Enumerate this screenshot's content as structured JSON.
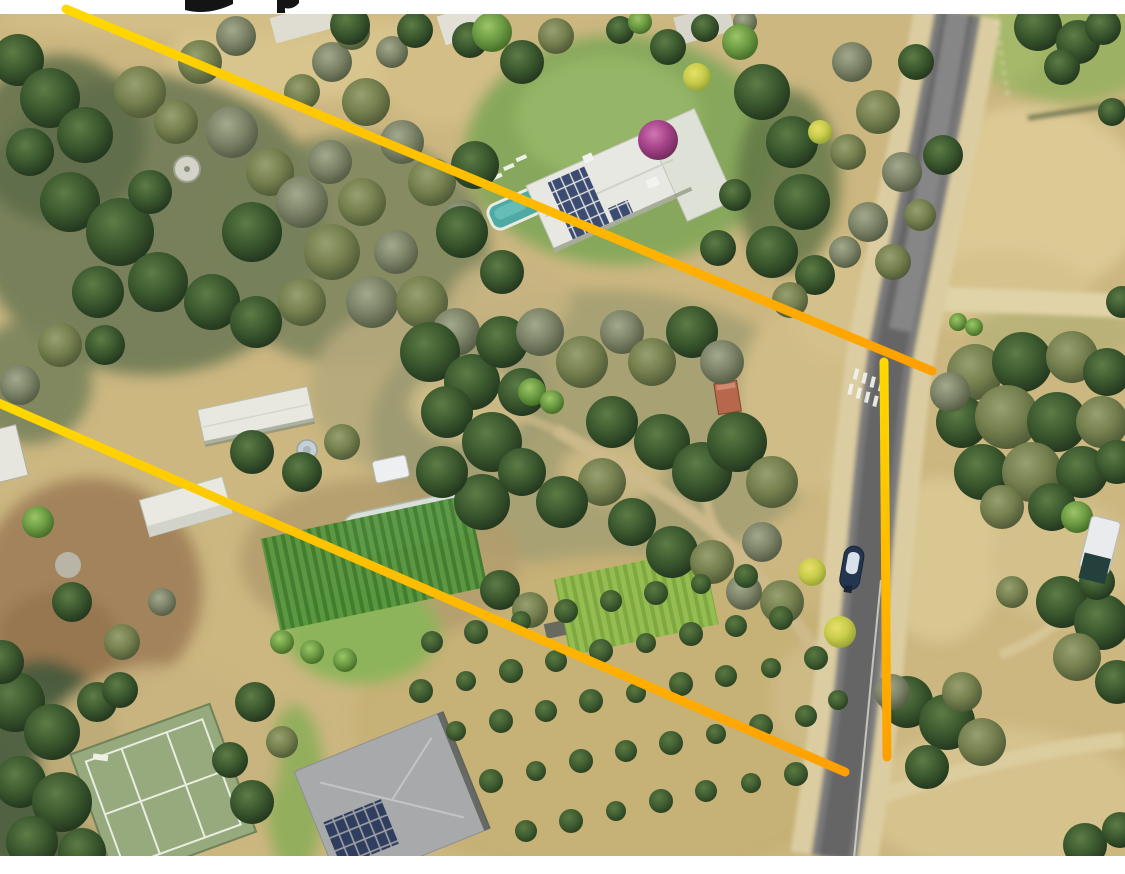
{
  "banner_top": {
    "background": "#ffffff",
    "height_px": 14
  },
  "banner_bottom": {
    "background": "#ffffff",
    "height_px": 18
  },
  "annotation": {
    "stroke_width": 9,
    "color_start": "#FFD900",
    "color_end": "#FFA000",
    "lines": [
      {
        "id": "boundary-line-top",
        "x1": 66,
        "y1": 9,
        "x2": 932,
        "y2": 371
      },
      {
        "id": "boundary-line-bottom",
        "x1": -6,
        "y1": 401,
        "x2": 845,
        "y2": 772
      },
      {
        "id": "boundary-line-road",
        "x1": 884,
        "y1": 362,
        "x2": 887,
        "y2": 757
      }
    ]
  },
  "colors": {
    "pool": "#4fa9a5",
    "road_asphalt": "#7a7a7a",
    "road_shoulder": "#dbcda1",
    "terrain_base": "#ccb780",
    "solar_panel": "#3c4b72",
    "tennis_court": "#96aa7d"
  }
}
